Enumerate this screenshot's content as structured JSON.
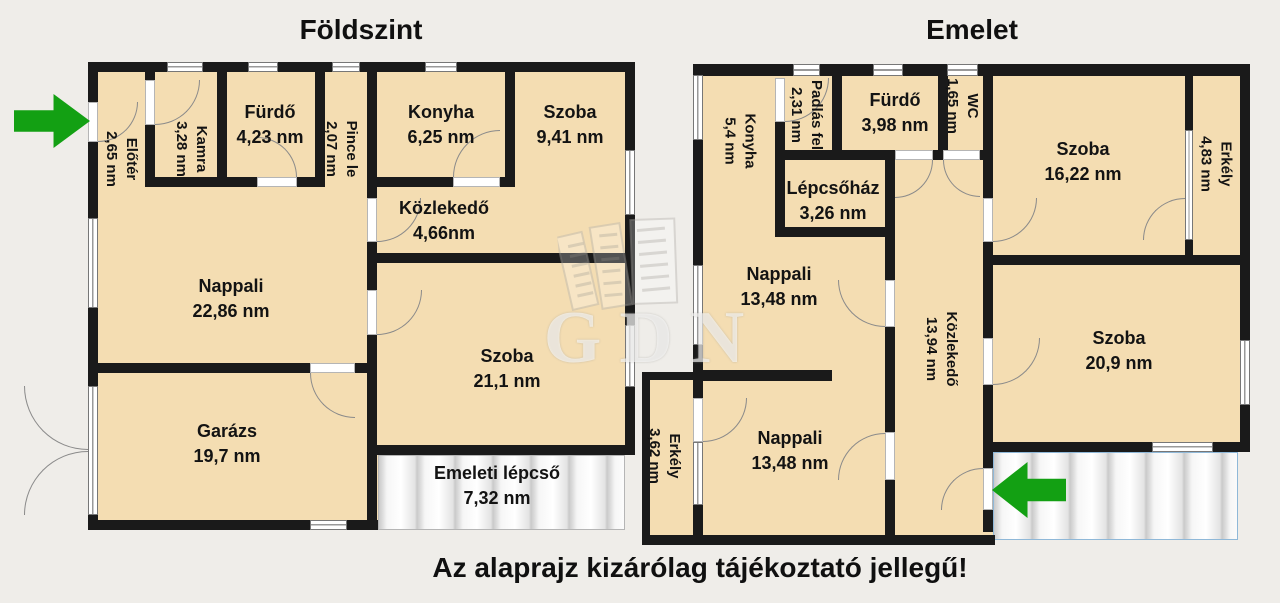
{
  "ground_title": "Földszint",
  "upper_title": "Emelet",
  "caption": "Az alaprajz kizárólag tájékoztató jellegű!",
  "watermark_text": "GDN",
  "rooms": {
    "g_eloter": {
      "name": "Előtér",
      "area": "2,65 nm"
    },
    "g_kamra": {
      "name": "Kamra",
      "area": "3,28 nm"
    },
    "g_furdo": {
      "name": "Fürdő",
      "area": "4,23 nm"
    },
    "g_pince": {
      "name": "Pince le",
      "area": "2,07 nm"
    },
    "g_konyha": {
      "name": "Konyha",
      "area": "6,25 nm"
    },
    "g_szoba1": {
      "name": "Szoba",
      "area": "9,41 nm"
    },
    "g_kozlekedo": {
      "name": "Közlekedő",
      "area": "4,66nm"
    },
    "g_nappali": {
      "name": "Nappali",
      "area": "22,86 nm"
    },
    "g_szoba2": {
      "name": "Szoba",
      "area": "21,1 nm"
    },
    "g_garazs": {
      "name": "Garázs",
      "area": "19,7 nm"
    },
    "g_lepcso": {
      "name": "Emeleti lépcső",
      "area": "7,32 nm"
    },
    "e_konyha": {
      "name": "Konyha",
      "area": "5,4 nm"
    },
    "e_padlas": {
      "name": "Padlás fel",
      "area": "2,31 nm"
    },
    "e_furdo": {
      "name": "Fürdő",
      "area": "3,98 nm"
    },
    "e_wc": {
      "name": "WC",
      "area": "1,65 nm"
    },
    "e_szoba1": {
      "name": "Szoba",
      "area": "16,22 nm"
    },
    "e_erkely1": {
      "name": "Erkély",
      "area": "4,83 nm"
    },
    "e_lepcsohaz": {
      "name": "Lépcsőház",
      "area": "3,26 nm"
    },
    "e_nappali1": {
      "name": "Nappali",
      "area": "13,48 nm"
    },
    "e_kozlekedo": {
      "name": "Közlekedő",
      "area": "13,94 nm"
    },
    "e_nappali2": {
      "name": "Nappali",
      "area": "13,48 nm"
    },
    "e_erkely2": {
      "name": "Erkély",
      "area": "3,62 nm"
    },
    "e_szoba2": {
      "name": "Szoba",
      "area": "20,9 nm"
    }
  },
  "colors": {
    "room_fill": "#f4ddb2",
    "wall": "#1a1a1a",
    "background": "#efede9",
    "arrow_green": "#13a013",
    "stairs_border_blue": "#8fb8d8"
  }
}
